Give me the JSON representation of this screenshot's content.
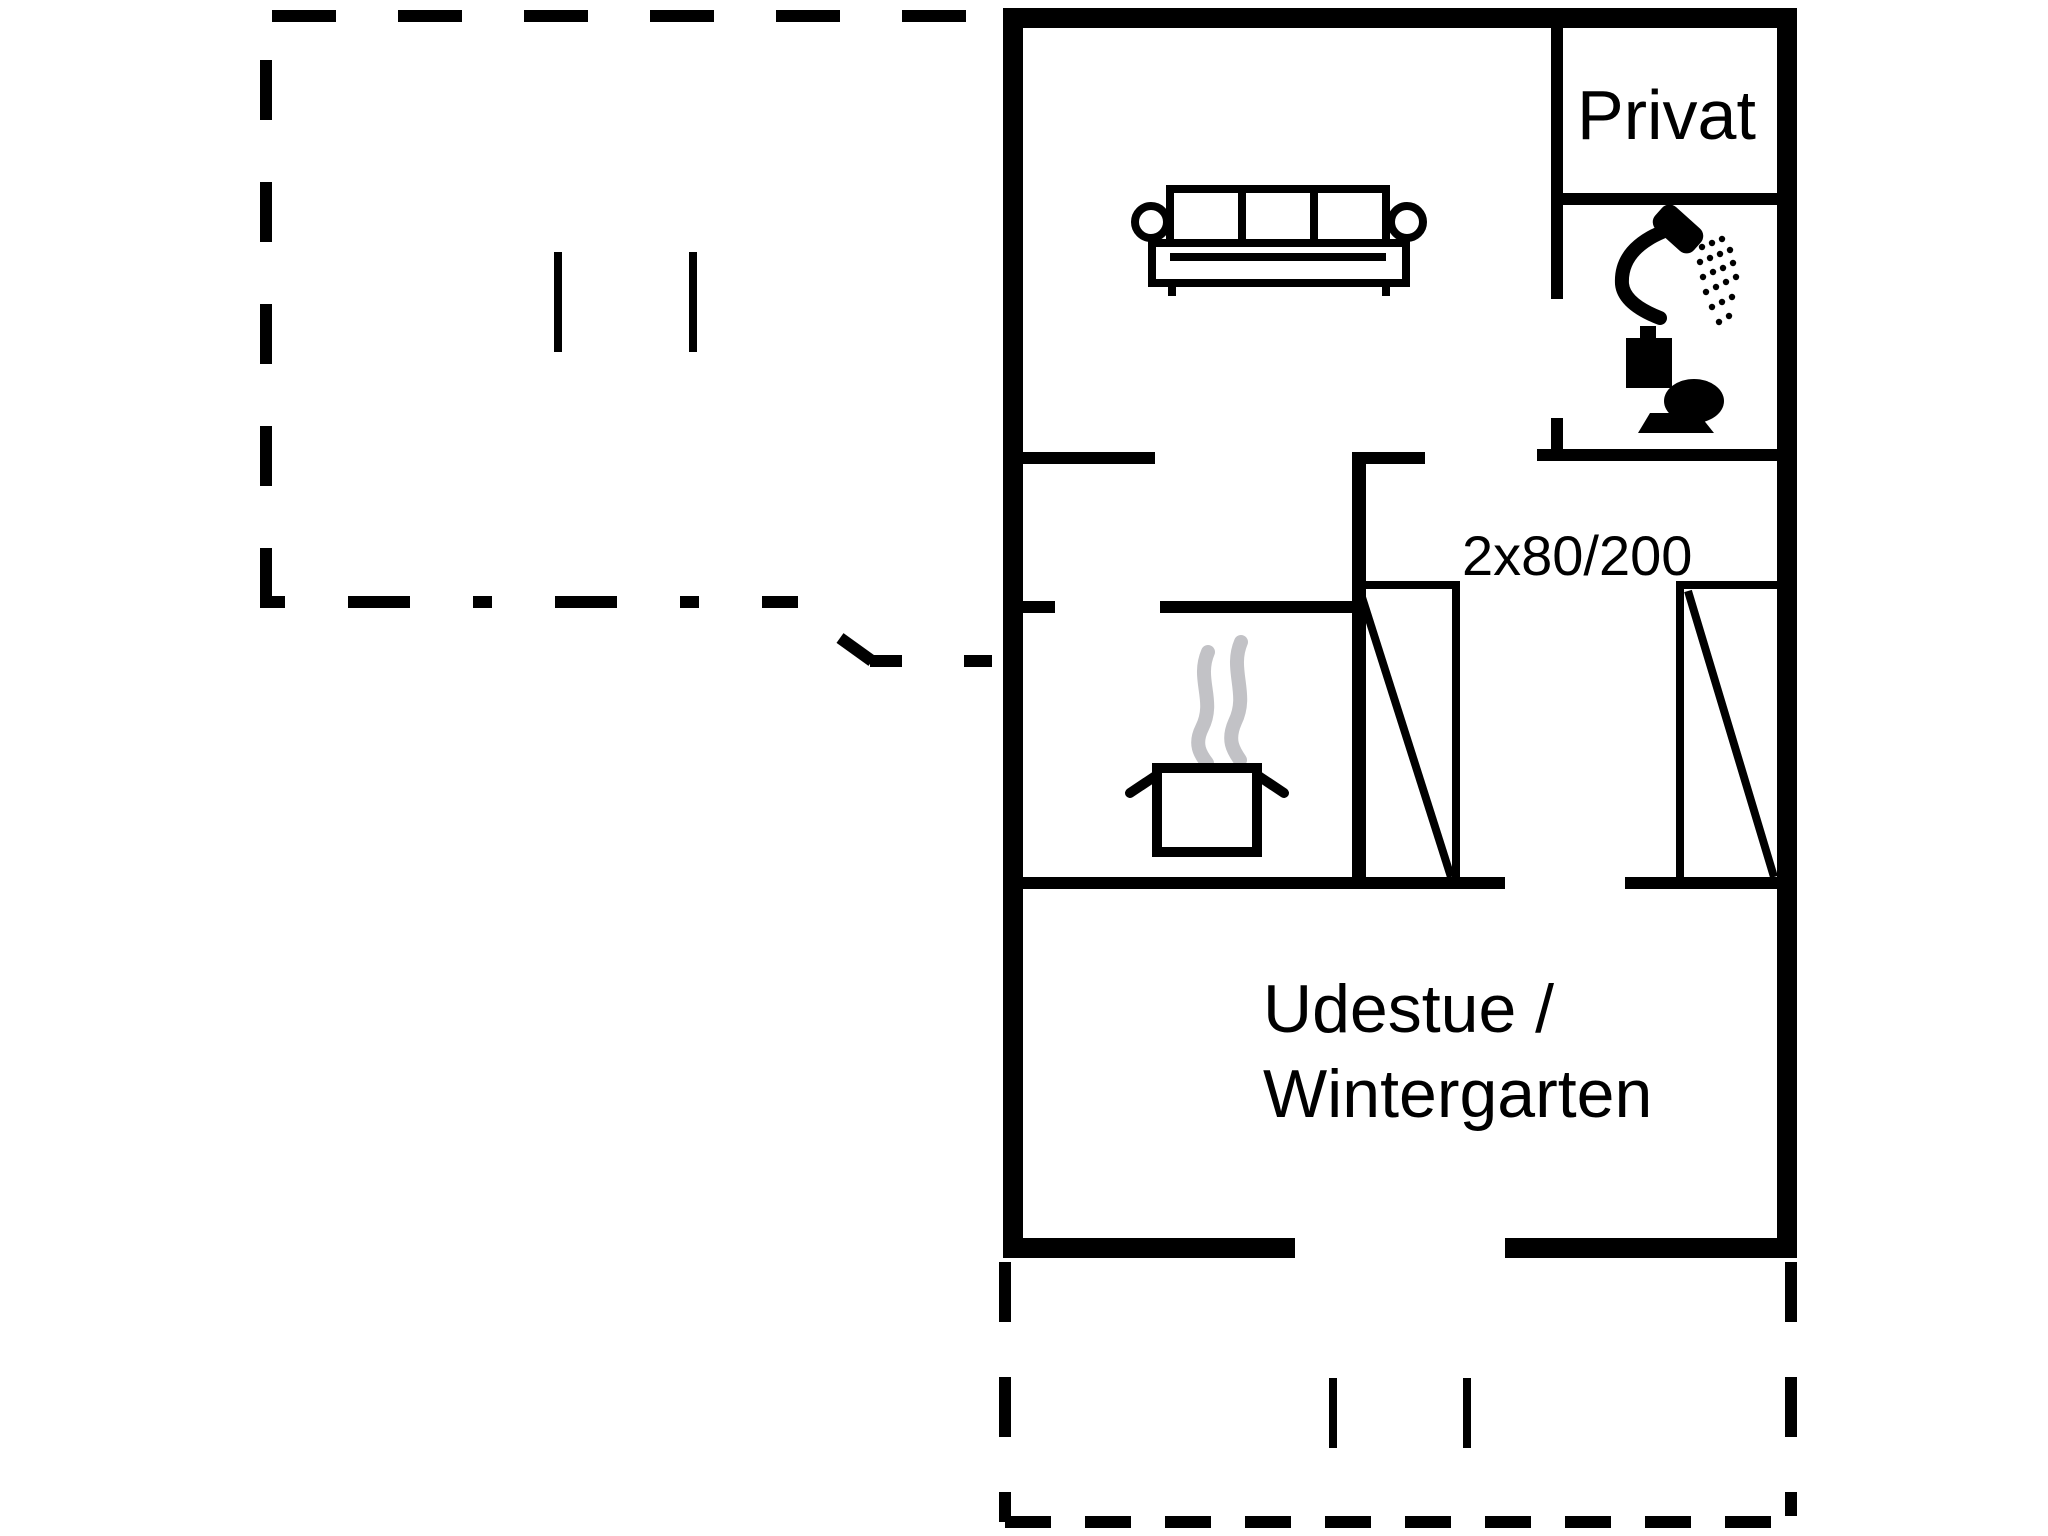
{
  "colors": {
    "line": "#000000",
    "background": "#ffffff",
    "steam": "#c2c2c6"
  },
  "floor_plan": {
    "labels": {
      "private": "Privat",
      "beds": "2x80/200",
      "winter_garden": [
        "Udestue /",
        "Wintergarten"
      ]
    },
    "icons": [
      {
        "name": "sofa-icon",
        "meaning": "living room sofa"
      },
      {
        "name": "shower-icon",
        "meaning": "shower in bathroom"
      },
      {
        "name": "toilet-icon",
        "meaning": "toilet in bathroom"
      },
      {
        "name": "cooking-pot-icon",
        "meaning": "kitchen / stove"
      },
      {
        "name": "steam-icon",
        "meaning": "steam above pot"
      }
    ]
  }
}
